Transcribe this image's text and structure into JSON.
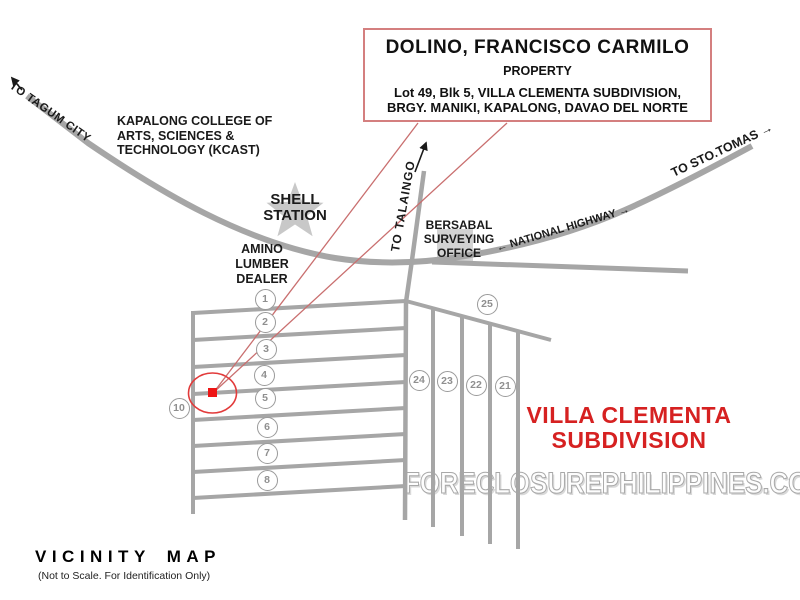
{
  "info_box": {
    "owner": "DOLINO, FRANCISCO CARMILO",
    "type_label": "PROPERTY",
    "address_line1": "Lot 49, Blk 5, VILLA CLEMENTA SUBDIVISION,",
    "address_line2": "BRGY. MANIKI, KAPALONG, DAVAO DEL NORTE"
  },
  "map": {
    "labels": {
      "to_tagum": "TO TAGUM CITY",
      "kcast_line1": "KAPALONG COLLEGE OF",
      "kcast_line2": "ARTS, SCIENCES &",
      "kcast_line3": "TECHNOLOGY (KCAST)",
      "shell_line1": "SHELL",
      "shell_line2": "STATION",
      "amino_line1": "AMINO",
      "amino_line2": "LUMBER",
      "amino_line3": "DEALER",
      "to_talaingo": "TO  TALAINGO",
      "bersabal_line1": "BERSABAL",
      "bersabal_line2": "SURVEYING",
      "bersabal_line3": "OFFICE",
      "national_highway": "← NATIONAL HIGHWAY →",
      "to_sto_tomas": "TO STO.TOMAS →",
      "subdivision_line1": "VILLA CLEMENTA",
      "subdivision_line2": "SUBDIVISION"
    },
    "lot_markers": [
      {
        "label": "1",
        "x": 265,
        "y": 299
      },
      {
        "label": "2",
        "x": 265,
        "y": 322
      },
      {
        "label": "3",
        "x": 266,
        "y": 349
      },
      {
        "label": "4",
        "x": 264,
        "y": 375
      },
      {
        "label": "5",
        "x": 265,
        "y": 398
      },
      {
        "label": "6",
        "x": 267,
        "y": 427
      },
      {
        "label": "7",
        "x": 267,
        "y": 453
      },
      {
        "label": "8",
        "x": 267,
        "y": 480
      },
      {
        "label": "10",
        "x": 179,
        "y": 408
      },
      {
        "label": "25",
        "x": 487,
        "y": 304
      },
      {
        "label": "24",
        "x": 419,
        "y": 380
      },
      {
        "label": "23",
        "x": 447,
        "y": 381
      },
      {
        "label": "22",
        "x": 476,
        "y": 385
      },
      {
        "label": "21",
        "x": 505,
        "y": 386
      }
    ],
    "colors": {
      "road_gray": "#a6a6a6",
      "accent_red": "#d62121",
      "callout_red": "#c96f6f",
      "marker_red": "#ee1515",
      "box_border_red": "#d47f7f"
    }
  },
  "watermark": "FORECLOSUREPHILIPPINES.COM",
  "footer": {
    "title": "VICINITY MAP",
    "subtitle": "(Not to Scale. For Identification Only)"
  }
}
